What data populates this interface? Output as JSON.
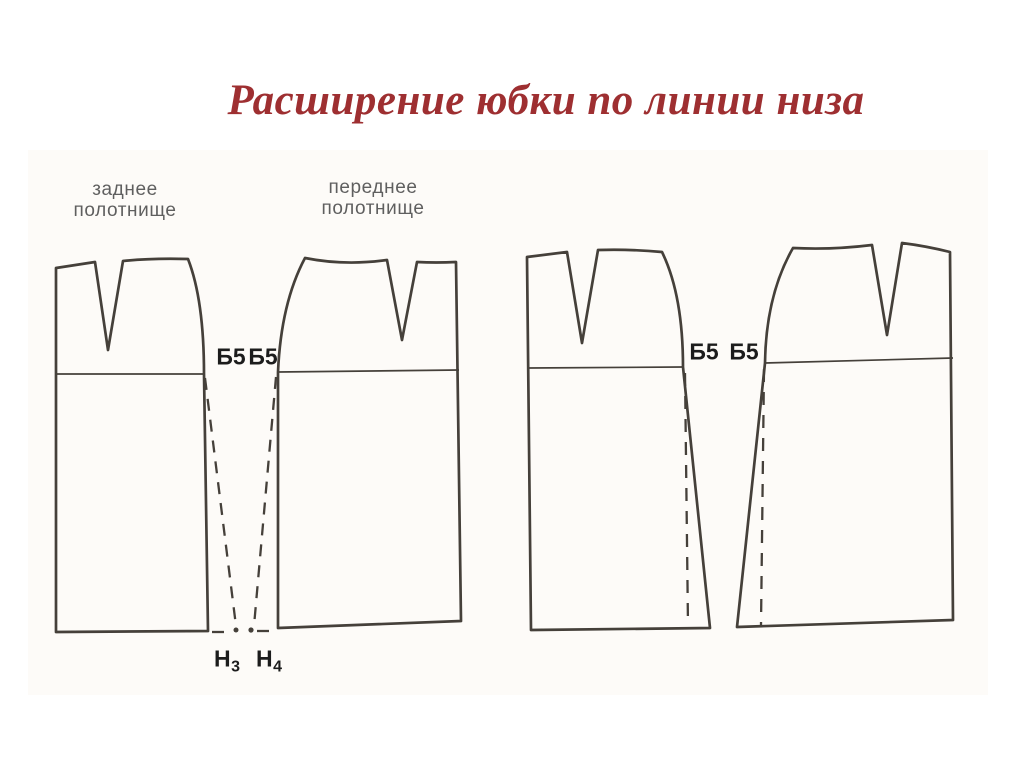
{
  "slide": {
    "title": "Расширение юбки по линии низа"
  },
  "diagram": {
    "panel_labels": {
      "back": {
        "line1": "заднее",
        "line2": "полотнище"
      },
      "front": {
        "line1": "переднее",
        "line2": "полотнище"
      }
    },
    "hip_labels": {
      "left_pair": [
        "Б5",
        "Б5"
      ],
      "right_pair": [
        "Б5",
        "Б5"
      ]
    },
    "hem_labels": {
      "h3": {
        "base": "Н",
        "sub": "3"
      },
      "h4": {
        "base": "Н",
        "sub": "4"
      }
    },
    "colors": {
      "title": "#9E2F31",
      "drawing_line": "#45403A",
      "point_label": "#1C1C1C",
      "panel_label": "#5F5F5F",
      "background": "#FFFFFF"
    }
  }
}
